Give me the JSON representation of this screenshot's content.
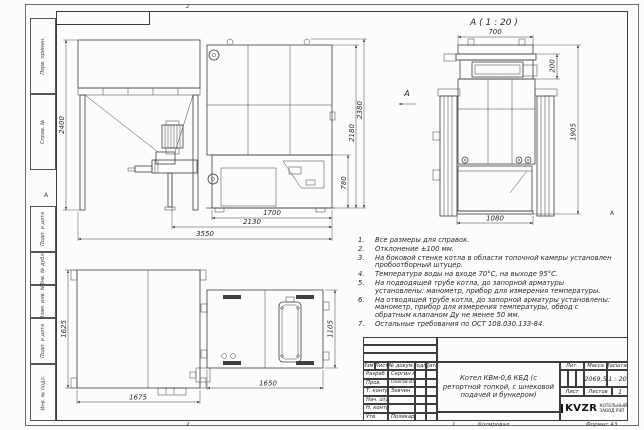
{
  "sheet": {
    "zone_top": "2",
    "zone_bottom_left": "2",
    "zone_bottom_right": "1",
    "fold_letter_left": "А",
    "fold_letter_right": "А",
    "footer_copied": "Копировал",
    "footer_format": "Формат А3",
    "margin_labels": [
      "Перв. примен.",
      "Справ. №",
      "Подп. и дата",
      "Инв. № дубл.",
      "Взам. инв. №",
      "Подп. и дата",
      "Инв. № подл."
    ]
  },
  "views": {
    "front": {
      "dim_bunker_height": "2400",
      "dim_right_inner": "780",
      "dim_right_mid": "2180",
      "dim_right_outer": "2380",
      "dim_bottom_1": "1700",
      "dim_bottom_2": "2130",
      "dim_bottom_3": "3550",
      "view_arrow_label": "А"
    },
    "detail": {
      "label": "А ( 1 : 20 )",
      "dim_top": "700",
      "dim_right_small": "200",
      "dim_right": "1905",
      "dim_bottom": "1080"
    },
    "top": {
      "dim_left": "1625",
      "dim_bottom_left": "1675",
      "dim_right": "1105",
      "dim_bottom_right": "1650"
    }
  },
  "notes": [
    {
      "num": "1.",
      "text": "Все размеры для справок."
    },
    {
      "num": "2.",
      "text": "Отклонение ±100 мм."
    },
    {
      "num": "3.",
      "text": "На боковой стенке котла в области топочной камеры установлен пробоотборный штуцер."
    },
    {
      "num": "4.",
      "text": "Температура воды на входе 70°С, на выходе 95°С."
    },
    {
      "num": "5.",
      "text": "На подводящей трубе котла, до запорной арматуры установлены: манометр, прибор для измерения температуры."
    },
    {
      "num": "6.",
      "text": "На отводящей трубе котла, до запорной арматуры установлены: манометр, прибор для измерения температуры, обвод с обратным клапаном Ду не менее 50 мм."
    },
    {
      "num": "7.",
      "text": "Остальные требования по ОСТ 108.030.133-84."
    }
  ],
  "title_block": {
    "header_cols": [
      "Изм.",
      "Лист",
      "№ докум.",
      "Подп.",
      "Дата"
    ],
    "rows": [
      {
        "role": "Разраб.",
        "name": "Сергин А.В."
      },
      {
        "role": "Пров.",
        "name": "Онегов-Варежинский"
      },
      {
        "role": "Т. контр.",
        "name": "Зевчин"
      },
      {
        "role": "Нач. отд.",
        "name": ""
      },
      {
        "role": "Н. контр.",
        "name": ""
      },
      {
        "role": "Утв.",
        "name": "Поликарпова"
      }
    ],
    "title": "Котел КВм-0,6 КБД (с ретортной топкой, с шнековой подачей и бункером)",
    "lit_label": "Лит.",
    "mass_label": "Масса",
    "scale_label": "Масштаб",
    "mass_value": "2069,5",
    "scale_value": "1 : 20",
    "sheet_label": "Лист",
    "sheets_label": "Листов",
    "sheets_value": "1",
    "logo_text": "KVZR",
    "logo_line1": "КОТЕЛЬНЫЙ",
    "logo_line2": "ЗАВОД РЭП"
  }
}
